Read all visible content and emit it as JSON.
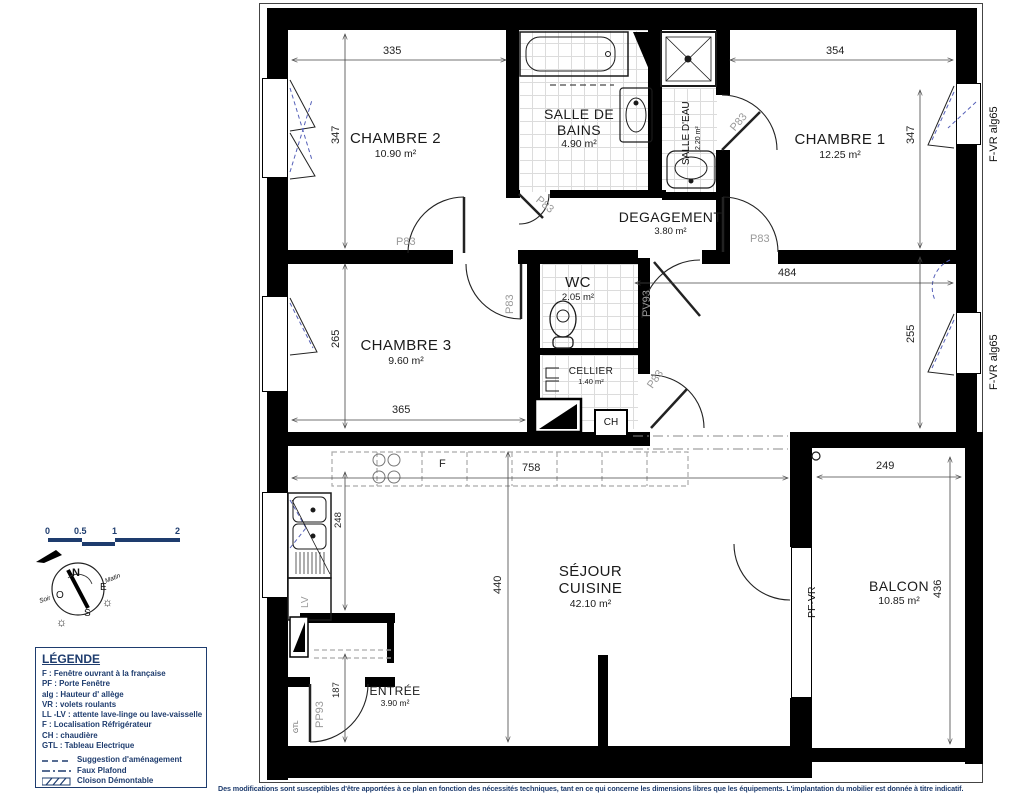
{
  "rooms": {
    "chambre2": {
      "name": "CHAMBRE 2",
      "area": "10.90 m²"
    },
    "salle_de_bains": {
      "name": "SALLE DE BAINS",
      "area": "4.90 m²"
    },
    "salle_deau": {
      "name": "SALLE D'EAU",
      "area": "2.20 m²"
    },
    "chambre1": {
      "name": "CHAMBRE 1",
      "area": "12.25 m²"
    },
    "degagement": {
      "name": "DEGAGEMENT",
      "area": "3.80 m²"
    },
    "wc": {
      "name": "WC",
      "area": "2.05 m²"
    },
    "chambre3": {
      "name": "CHAMBRE 3",
      "area": "9.60 m²"
    },
    "cellier": {
      "name": "CELLIER",
      "area": "1.40 m²"
    },
    "sejour": {
      "name": "SÉJOUR\nCUISINE",
      "area": "42.10 m²"
    },
    "balcon": {
      "name": "BALCON",
      "area": "10.85 m²"
    },
    "entree": {
      "name": "ENTRÉE",
      "area": "3.90 m²"
    }
  },
  "dimensions": {
    "ch2_w": "335",
    "ch2_h": "347",
    "ch1_w": "354",
    "ch1_h": "347",
    "open_w": "484",
    "open_h": "255",
    "ch3_h": "265",
    "ch3_w": "365",
    "sejour_w": "758",
    "sejour_h": "440",
    "kitchen_h": "248",
    "entree_h": "187",
    "balcon_w": "249",
    "balcon_h": "436"
  },
  "door_labels": {
    "p83": "P83",
    "pv93": "PV93",
    "pp93": "PP93"
  },
  "window_labels": {
    "f_vr": "F-VR alg65",
    "pf_vr": "PF-VR"
  },
  "equipment": {
    "lv": "LV",
    "ch": "CH",
    "gtl": "GTL",
    "fridge": "F"
  },
  "legend": {
    "title": "LÉGENDE",
    "items": [
      "F : Fenêtre ouvrant à la française",
      "PF : Porte Fenêtre",
      "alg :  Hauteur d' allège",
      "VR : volets roulants",
      "LL -LV : attente lave-linge ou lave-vaisselle",
      "F : Localisation Réfrigérateur",
      "CH : chaudière",
      "GTL : Tableau Electrique"
    ],
    "line_items": {
      "suggestion": "Suggestion d'aménagement",
      "faux_plafond": "Faux Plafond",
      "cloison": "Cloison Démontable"
    }
  },
  "scale_bar": {
    "ticks": [
      "0",
      "0.5",
      "1",
      "2"
    ]
  },
  "compass": {
    "n": "N",
    "e": "E",
    "s": "S",
    "o": "O",
    "matin": "Matin",
    "soir": "Soir"
  },
  "disclaimer": "Des modifications sont susceptibles d'être apportées à ce plan en fonction des nécessités techniques, tant en ce qui concerne les dimensions libres que les équipements. L'implantation du mobilier est donnée à titre indicatif.",
  "colors": {
    "wall": "#000000",
    "navy": "#1e3c6e",
    "door_label_gray": "#9a9a9a",
    "window_swing_blue": "#5560b8",
    "tile_gray": "#dcdcdc"
  }
}
